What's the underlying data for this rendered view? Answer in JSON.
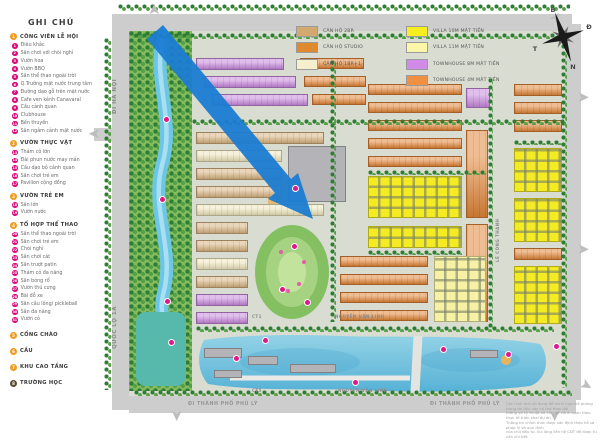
{
  "legend": {
    "title": "GHI CHÚ",
    "sections": [
      {
        "num": "1",
        "label": "CÔNG VIÊN LỄ HỘI",
        "items": [
          {
            "n": "1",
            "label": "Điêu khắc"
          },
          {
            "n": "2",
            "label": "Sân chơi với chòi nghỉ"
          },
          {
            "n": "3",
            "label": "Vườn hoa"
          },
          {
            "n": "4",
            "label": "Vườn BBQ"
          },
          {
            "n": "5",
            "label": "Sân thể thao ngoài trời"
          },
          {
            "n": "6",
            "label": "Q.Trường mặt nước trung tâm"
          },
          {
            "n": "7",
            "label": "Đường dạo gỗ trên mặt nước"
          },
          {
            "n": "8",
            "label": "Cafe ven kênh Canavaral"
          },
          {
            "n": "9",
            "label": "Cầu cảnh quan"
          },
          {
            "n": "10",
            "label": "Clubhouse"
          },
          {
            "n": "11",
            "label": "Bến thuyền"
          },
          {
            "n": "12",
            "label": "Sân ngắm cảnh mặt nước"
          }
        ]
      },
      {
        "num": "2",
        "label": "VƯỜN THỰC VẬT",
        "items": [
          {
            "n": "13",
            "label": "Thảm cỏ lớn"
          },
          {
            "n": "14",
            "label": "Đài phun nước may mắn"
          },
          {
            "n": "15",
            "label": "Cầu dạo bộ cảnh quan"
          },
          {
            "n": "16",
            "label": "Sân chơi trẻ em"
          },
          {
            "n": "17",
            "label": "Pavilion cộng đồng"
          }
        ]
      },
      {
        "num": "3",
        "label": "VƯỜN TRẺ EM",
        "items": [
          {
            "n": "18",
            "label": "Sân lớn"
          },
          {
            "n": "19",
            "label": "Vườn nước"
          }
        ]
      },
      {
        "num": "4",
        "label": "TỔ HỢP THỂ THAO",
        "items": [
          {
            "n": "20",
            "label": "Sân thể thao ngoài trời"
          },
          {
            "n": "21",
            "label": "Sân chơi trẻ em"
          },
          {
            "n": "22",
            "label": "Chòi nghỉ"
          },
          {
            "n": "23",
            "label": "Sân chơi cát"
          },
          {
            "n": "24",
            "label": "Sân trượt patin"
          },
          {
            "n": "25",
            "label": "Thảm cỏ đa năng"
          },
          {
            "n": "26",
            "label": "Sân bóng rổ"
          },
          {
            "n": "27",
            "label": "Vườn thú cưng"
          },
          {
            "n": "28",
            "label": "Bãi đỗ xe"
          },
          {
            "n": "29",
            "label": "Sân cầu lông/ pickleball"
          },
          {
            "n": "30",
            "label": "Sân đa năng"
          },
          {
            "n": "31",
            "label": "Vườn cỏ"
          }
        ]
      },
      {
        "num": "5",
        "label": "CỔNG CHÀO",
        "items": []
      },
      {
        "num": "6",
        "label": "CẦU",
        "items": []
      },
      {
        "num": "7",
        "label": "KHU CAO TẦNG",
        "items": []
      },
      {
        "num": "8",
        "label": "TRƯỜNG HỌC",
        "items": [],
        "icon_color": "#5b4a32"
      }
    ]
  },
  "unit_legend": {
    "left": [
      {
        "color": "#d2a96e",
        "label": "CĂN HỘ 2BR"
      },
      {
        "color": "#e08a30",
        "label": "CĂN HỘ STUDIO"
      },
      {
        "color": "#f6efcd",
        "label": "CĂN HỘ 1BR+1"
      }
    ],
    "right": [
      {
        "color": "#f7ee20",
        "label": "VILLA 10M MẶT TIỀN"
      },
      {
        "color": "#fbf7a8",
        "label": "VILLA 11M MẶT TIỀN"
      },
      {
        "color": "#d08be8",
        "label": "TOWNHOUSE 8M MẶT TIỀN"
      },
      {
        "color": "#ef9043",
        "label": "TOWNHOUSE 4M MẶT TIỀN"
      }
    ]
  },
  "compass": {
    "north": "B",
    "east": "Đ",
    "south": "N",
    "west": "T"
  },
  "icons": {
    "entry_arrow": "➤"
  },
  "colors": {
    "section_badge": "#f09a1f",
    "item_badge": "#d80d7b",
    "arrow_blue": "#1b7cd2",
    "road_gray": "#cdcdcd",
    "canal_blue": "#6ec6e6",
    "lake_deep": "#57b2d6",
    "park_green": "#83bb5e"
  },
  "map_labels": [
    {
      "text": "ĐI HÀ NỘI",
      "x": 112,
      "y": 66,
      "h": 60,
      "vert": true,
      "size": "lg"
    },
    {
      "text": "QUỐC LỘ 1A",
      "x": 112,
      "y": 296,
      "h": 64,
      "vert": true,
      "size": "lg"
    },
    {
      "text": "LÊ CÔNG THANH",
      "x": 495,
      "y": 210,
      "h": 60,
      "vert": true,
      "size": "sm"
    },
    {
      "text": "NGUYỄN VĂN LINH",
      "x": 335,
      "y": 314,
      "size": "sm"
    },
    {
      "text": "NGUYỄN VĂN LINH",
      "x": 338,
      "y": 388,
      "size": "sm"
    },
    {
      "text": "CT1",
      "x": 252,
      "y": 314,
      "size": "sm"
    },
    {
      "text": "CT5",
      "x": 252,
      "y": 388,
      "size": "sm"
    },
    {
      "text": "ĐI THÀNH PHỐ PHỦ LÝ",
      "x": 188,
      "y": 402,
      "size": "md"
    },
    {
      "text": "ĐI THÀNH PHỐ PHỦ LÝ",
      "x": 430,
      "y": 402,
      "size": "md"
    }
  ],
  "disclaimer": {
    "lines": [
      "Các hình ảnh sử dụng để minh họa/mô phỏng trong tài liệu này có thể thay đổi",
      "thông số kỹ thuật và chi tiết cảnh quan theo thực tế triển khai dự án.",
      "Thông tin chính thức được xác định theo hồ sơ pháp lý và quy định",
      "của chủ đầu tư. Vui lòng liên hệ CĐT để được tư vấn chi tiết."
    ]
  },
  "map": {
    "palette": {
      "tan": "#d9b583",
      "cream": "#efe6bd",
      "orange": "#e2873a",
      "purple": "#c98ade",
      "yellow": "#f4eb22",
      "paleyellow": "#f7f2a3",
      "gray": "#b4b4b8"
    },
    "clusters": [
      [
        196,
        58,
        88,
        12,
        "purple",
        "rows"
      ],
      [
        204,
        76,
        92,
        12,
        "purple",
        "rows"
      ],
      [
        212,
        94,
        96,
        12,
        "purple",
        "rows"
      ],
      [
        300,
        58,
        64,
        11,
        "orange",
        "rows"
      ],
      [
        304,
        76,
        62,
        11,
        "orange",
        "rows"
      ],
      [
        312,
        94,
        54,
        11,
        "orange",
        "rows"
      ],
      [
        196,
        132,
        128,
        12,
        "tan",
        "rows"
      ],
      [
        196,
        150,
        86,
        12,
        "cream",
        "rows"
      ],
      [
        196,
        168,
        86,
        12,
        "tan",
        "rows"
      ],
      [
        196,
        186,
        86,
        12,
        "tan",
        "rows"
      ],
      [
        196,
        204,
        128,
        12,
        "cream",
        "rows"
      ],
      [
        196,
        222,
        52,
        12,
        "tan",
        "rows"
      ],
      [
        196,
        240,
        52,
        12,
        "tan",
        "rows"
      ],
      [
        196,
        258,
        52,
        12,
        "cream",
        "rows"
      ],
      [
        196,
        276,
        52,
        12,
        "tan",
        "rows"
      ],
      [
        196,
        294,
        52,
        12,
        "purple",
        "rows"
      ],
      [
        196,
        312,
        52,
        12,
        "purple",
        "rows"
      ],
      [
        288,
        146,
        58,
        56,
        "gray",
        ""
      ],
      [
        368,
        84,
        94,
        11,
        "orange",
        "rows"
      ],
      [
        368,
        102,
        94,
        11,
        "orange",
        "rows"
      ],
      [
        368,
        120,
        94,
        11,
        "orange",
        "rows"
      ],
      [
        368,
        138,
        94,
        11,
        "orange",
        "rows"
      ],
      [
        368,
        156,
        94,
        11,
        "orange",
        "rows"
      ],
      [
        466,
        88,
        24,
        20,
        "purple",
        "rows"
      ],
      [
        368,
        176,
        94,
        42,
        "yellow",
        "grid"
      ],
      [
        368,
        226,
        94,
        22,
        "yellow",
        "grid"
      ],
      [
        466,
        130,
        22,
        88,
        "orange",
        "rows"
      ],
      [
        466,
        224,
        22,
        98,
        "orange",
        "rows"
      ],
      [
        340,
        256,
        88,
        11,
        "orange",
        "rows"
      ],
      [
        340,
        274,
        88,
        11,
        "orange",
        "rows"
      ],
      [
        340,
        292,
        88,
        11,
        "orange",
        "rows"
      ],
      [
        340,
        310,
        88,
        11,
        "orange",
        "rows"
      ],
      [
        434,
        256,
        52,
        66,
        "paleyellow",
        "grid"
      ],
      [
        514,
        84,
        48,
        12,
        "orange",
        "rows"
      ],
      [
        514,
        102,
        48,
        12,
        "orange",
        "rows"
      ],
      [
        514,
        120,
        48,
        12,
        "orange",
        "rows"
      ],
      [
        514,
        148,
        48,
        44,
        "yellow",
        "grid"
      ],
      [
        514,
        198,
        48,
        44,
        "yellow",
        "grid"
      ],
      [
        514,
        248,
        48,
        12,
        "orange",
        "rows"
      ],
      [
        514,
        266,
        48,
        58,
        "yellow",
        "grid"
      ],
      [
        204,
        348,
        38,
        10,
        "gray",
        ""
      ],
      [
        248,
        356,
        30,
        9,
        "gray",
        ""
      ],
      [
        290,
        364,
        46,
        9,
        "gray",
        ""
      ],
      [
        214,
        370,
        28,
        8,
        "gray",
        ""
      ],
      [
        470,
        350,
        28,
        8,
        "gray",
        ""
      ]
    ],
    "tree_strips": [
      [
        118,
        4,
        452,
        7
      ],
      [
        134,
        33,
        434,
        6
      ],
      [
        104,
        38,
        7,
        352
      ],
      [
        561,
        30,
        6,
        358
      ],
      [
        134,
        390,
        438,
        6
      ],
      [
        196,
        326,
        358,
        6
      ],
      [
        192,
        119,
        374,
        6
      ],
      [
        330,
        60,
        6,
        262
      ],
      [
        488,
        78,
        5,
        252
      ],
      [
        368,
        170,
        118,
        5
      ],
      [
        368,
        250,
        94,
        5
      ],
      [
        514,
        140,
        48,
        5
      ]
    ],
    "entry_arrows": [
      [
        148,
        2,
        -90
      ],
      [
        550,
        10,
        -55
      ],
      [
        88,
        126,
        180
      ],
      [
        170,
        408,
        90
      ],
      [
        548,
        408,
        90
      ],
      [
        577,
        90,
        0
      ],
      [
        577,
        242,
        0
      ],
      [
        580,
        378,
        30
      ]
    ],
    "markers": [
      [
        163,
        116
      ],
      [
        159,
        196
      ],
      [
        164,
        298
      ],
      [
        291,
        243
      ],
      [
        279,
        286
      ],
      [
        304,
        299
      ],
      [
        262,
        337
      ],
      [
        233,
        355
      ],
      [
        352,
        379
      ],
      [
        440,
        346
      ],
      [
        505,
        351
      ],
      [
        553,
        343
      ],
      [
        292,
        185
      ],
      [
        168,
        339
      ]
    ]
  }
}
